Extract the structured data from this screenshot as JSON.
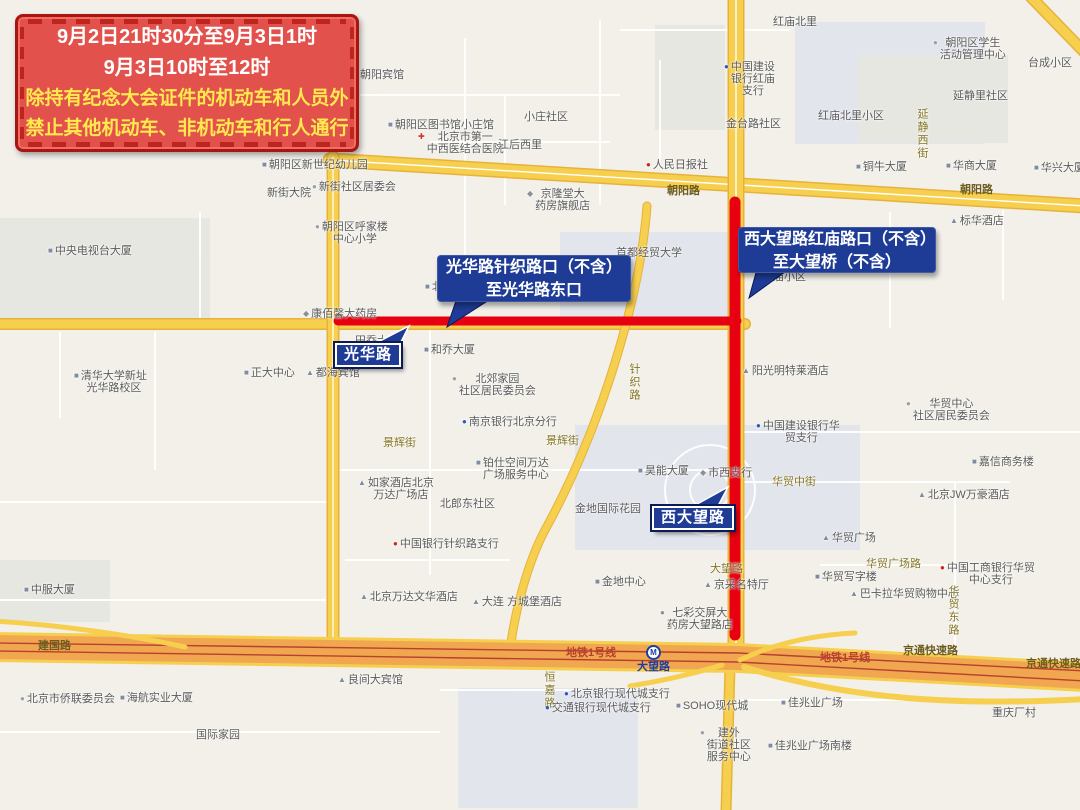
{
  "theme": {
    "map_bg": "#f2f0e9",
    "block_gray": "#e7e7e2",
    "block_blue": "#e2e5ec",
    "road_yellow": "#f7cf4f",
    "road_yellow_edge": "#e6b23a",
    "expressway_orange": "#f0a750",
    "rail_red": "#b8402e",
    "restriction_red": "#e60012",
    "callout_blue": "#1e3c96",
    "callout_border_navy": "#0c1a56",
    "banner_bg": "#e2514b",
    "banner_border": "#a81512",
    "banner_dash": "#bf241f",
    "banner_text_white": "#ffffff",
    "banner_text_yellow": "#ffe94e",
    "poi_text": "#5a5a5a",
    "street_text": "#857422",
    "metro_blue": "#1d3fa0"
  },
  "banner": {
    "lines": [
      "9月2日21时30分至9月3日1时",
      "9月3日10时至12时",
      "除持有纪念大会证件的机动车和人员外",
      "禁止其他机动车、非机动车和行人通行"
    ]
  },
  "callouts": {
    "guanghua": {
      "line1": "光华路针织路口（不含）",
      "line2": "至光华路东口"
    },
    "xidawang": {
      "line1": "西大望路红庙路口（不含）",
      "line2": "至大望桥（不含）"
    }
  },
  "road_tags": {
    "guanghua": "光华路",
    "xidawang": "西大望路"
  },
  "metro_station": {
    "name": "大望路"
  },
  "labels": [
    {
      "text": "朝阳宾馆",
      "x": 360,
      "y": 69
    },
    {
      "text": "朝阳区图书馆小庄馆",
      "x": 388,
      "y": 119,
      "icon": "building"
    },
    {
      "lines": [
        "北京市第一",
        "中西医结合医院"
      ],
      "x": 418,
      "y": 131,
      "icon": "hospital"
    },
    {
      "text": "小庄社区",
      "x": 524,
      "y": 111
    },
    {
      "text": "江后西里",
      "x": 498,
      "y": 139
    },
    {
      "text": "人民日报社",
      "x": 646,
      "y": 159,
      "icon": "bank-red"
    },
    {
      "text": "铜牛大厦",
      "x": 856,
      "y": 161,
      "icon": "building"
    },
    {
      "text": "朝阳区新世纪幼儿园",
      "x": 262,
      "y": 159,
      "icon": "building"
    },
    {
      "text": "新街大院",
      "x": 267,
      "y": 187
    },
    {
      "text": "新街社区居委会",
      "x": 312,
      "y": 181,
      "icon": "dot"
    },
    {
      "lines": [
        "朝阳区呼家楼",
        "中心小学"
      ],
      "x": 315,
      "y": 221,
      "icon": "dot"
    },
    {
      "lines": [
        "京隆堂大",
        "药房旗舰店"
      ],
      "x": 527,
      "y": 188,
      "icon": "shop"
    },
    {
      "text": "红庙北里",
      "x": 773,
      "y": 16
    },
    {
      "lines": [
        "朝阳区学生",
        "活动管理中心"
      ],
      "x": 933,
      "y": 37,
      "icon": "dot"
    },
    {
      "text": "台成小区",
      "x": 1028,
      "y": 57
    },
    {
      "lines": [
        "中国建设",
        "银行红庙",
        "支行"
      ],
      "x": 724,
      "y": 61,
      "icon": "bank-blue"
    },
    {
      "text": "延静里社区",
      "x": 953,
      "y": 90
    },
    {
      "text": "红庙北里小区",
      "x": 818,
      "y": 110
    },
    {
      "text": "金台路社区",
      "x": 726,
      "y": 118
    },
    {
      "text": "华商大厦",
      "x": 946,
      "y": 160,
      "icon": "building"
    },
    {
      "text": "华兴大厦",
      "x": 1034,
      "y": 162,
      "icon": "building"
    },
    {
      "text": "朝阳路",
      "x": 667,
      "y": 185,
      "cls": "road"
    },
    {
      "text": "朝阳路",
      "x": 960,
      "y": 184,
      "cls": "road"
    },
    {
      "text": "标华酒店",
      "x": 950,
      "y": 215,
      "icon": "hotel"
    },
    {
      "text": "延静西街",
      "x": 916,
      "y": 108,
      "vertical": true,
      "cls": "street"
    },
    {
      "text": "首都经贸大学",
      "x": 616,
      "y": 247
    },
    {
      "text": "红庙小区",
      "x": 762,
      "y": 271
    },
    {
      "text": "北京信苑大厦",
      "x": 425,
      "y": 281,
      "icon": "building"
    },
    {
      "text": "康佰馨大药房",
      "x": 303,
      "y": 308,
      "icon": "shop"
    },
    {
      "text": "田乔大厦",
      "x": 355,
      "y": 335
    },
    {
      "text": "和乔大厦",
      "x": 424,
      "y": 344,
      "icon": "building"
    },
    {
      "text": "正大中心",
      "x": 244,
      "y": 367,
      "icon": "building"
    },
    {
      "text": "都海宾馆",
      "x": 306,
      "y": 367,
      "icon": "hotel"
    },
    {
      "lines": [
        "清华大学新址",
        "光华路校区"
      ],
      "x": 74,
      "y": 370,
      "icon": "building"
    },
    {
      "text": "中央电视台大厦",
      "x": 48,
      "y": 245,
      "icon": "building"
    },
    {
      "text": "针织路",
      "x": 628,
      "y": 363,
      "vertical": true,
      "cls": "street"
    },
    {
      "lines": [
        "北郊家园",
        "社区居民委员会"
      ],
      "x": 452,
      "y": 373,
      "icon": "dot"
    },
    {
      "text": "南京银行北京分行",
      "x": 462,
      "y": 416,
      "icon": "bank-blue"
    },
    {
      "text": "景辉街",
      "x": 383,
      "y": 437,
      "cls": "street"
    },
    {
      "text": "景辉街",
      "x": 546,
      "y": 435,
      "cls": "street"
    },
    {
      "lines": [
        "铂仕空间万达",
        "广场服务中心"
      ],
      "x": 476,
      "y": 457,
      "icon": "building"
    },
    {
      "text": "昊能大厦",
      "x": 638,
      "y": 465,
      "icon": "building"
    },
    {
      "text": "市西支行",
      "x": 700,
      "y": 467,
      "icon": "shop"
    },
    {
      "text": "阳光明特莱酒店",
      "x": 742,
      "y": 365,
      "icon": "hotel"
    },
    {
      "lines": [
        "如家酒店北京",
        "万达广场店"
      ],
      "x": 358,
      "y": 477,
      "icon": "hotel"
    },
    {
      "text": "北郎东社区",
      "x": 440,
      "y": 498
    },
    {
      "text": "中国银行针织路支行",
      "x": 393,
      "y": 538,
      "icon": "bank-red"
    },
    {
      "text": "金地国际花园",
      "x": 575,
      "y": 503
    },
    {
      "lines": [
        "中国建设银行华",
        "贸支行"
      ],
      "x": 756,
      "y": 420,
      "icon": "bank-blue"
    },
    {
      "lines": [
        "华贸中心",
        "社区居民委员会"
      ],
      "x": 906,
      "y": 398,
      "icon": "dot"
    },
    {
      "text": "嘉信商务楼",
      "x": 972,
      "y": 456,
      "icon": "building"
    },
    {
      "text": "华贸中街",
      "x": 772,
      "y": 476,
      "cls": "street"
    },
    {
      "text": "北京JW万豪酒店",
      "x": 918,
      "y": 489,
      "icon": "hotel"
    },
    {
      "text": "华贸广场",
      "x": 822,
      "y": 532,
      "icon": "hotel"
    },
    {
      "text": "华贸广场路",
      "x": 866,
      "y": 558,
      "cls": "street"
    },
    {
      "text": "华贸写字楼",
      "x": 815,
      "y": 571,
      "icon": "building"
    },
    {
      "lines": [
        "中国工商银行华贸",
        "中心支行"
      ],
      "x": 940,
      "y": 562,
      "icon": "bank-red"
    },
    {
      "text": "巴卡拉华贸购物中心",
      "x": 850,
      "y": 588,
      "icon": "hotel"
    },
    {
      "text": "华贸东路",
      "x": 947,
      "y": 585,
      "vertical": true,
      "cls": "street"
    },
    {
      "text": "中服大厦",
      "x": 24,
      "y": 584,
      "icon": "building"
    },
    {
      "text": "建国路",
      "x": 38,
      "y": 640,
      "cls": "road"
    },
    {
      "text": "北京市侨联委员会",
      "x": 20,
      "y": 693,
      "icon": "dot"
    },
    {
      "text": "海航实业大厦",
      "x": 120,
      "y": 692,
      "icon": "building"
    },
    {
      "text": "国际家园",
      "x": 196,
      "y": 729
    },
    {
      "text": "良间大宾馆",
      "x": 338,
      "y": 674,
      "icon": "hotel"
    },
    {
      "text": "北京万达文华酒店",
      "x": 360,
      "y": 591,
      "icon": "hotel"
    },
    {
      "text": "大连 方城堡酒店",
      "x": 472,
      "y": 596,
      "icon": "hotel"
    },
    {
      "text": "金地中心",
      "x": 595,
      "y": 576,
      "icon": "building"
    },
    {
      "lines": [
        "七彩交屏大",
        "药房大望路店"
      ],
      "x": 660,
      "y": 607,
      "icon": "info"
    },
    {
      "text": "大望路",
      "x": 710,
      "y": 563,
      "cls": "street"
    },
    {
      "text": "京采名特厅",
      "x": 704,
      "y": 579,
      "icon": "hotel"
    },
    {
      "text": "地铁1号线",
      "x": 566,
      "y": 647,
      "cls": "metro"
    },
    {
      "text": "地铁1号线",
      "x": 820,
      "y": 652,
      "cls": "metro"
    },
    {
      "text": "京通快速路",
      "x": 903,
      "y": 645,
      "cls": "road"
    },
    {
      "text": "京通快速路",
      "x": 1026,
      "y": 658,
      "cls": "road"
    },
    {
      "text": "恒嘉路",
      "x": 543,
      "y": 671,
      "vertical": true,
      "cls": "street"
    },
    {
      "text": "北京银行现代城支行",
      "x": 564,
      "y": 688,
      "icon": "bank-blue"
    },
    {
      "text": "交通银行现代城支行",
      "x": 545,
      "y": 702,
      "icon": "bank-blue"
    },
    {
      "text": "SOHO现代城",
      "x": 676,
      "y": 700,
      "icon": "building"
    },
    {
      "lines": [
        "建外",
        "街道社区",
        "服务中心"
      ],
      "x": 700,
      "y": 727,
      "icon": "dot"
    },
    {
      "text": "佳兆业广场",
      "x": 781,
      "y": 697,
      "icon": "building"
    },
    {
      "text": "佳兆业广场南楼",
      "x": 768,
      "y": 740,
      "icon": "building"
    },
    {
      "text": "重庆厂村",
      "x": 992,
      "y": 707
    }
  ]
}
